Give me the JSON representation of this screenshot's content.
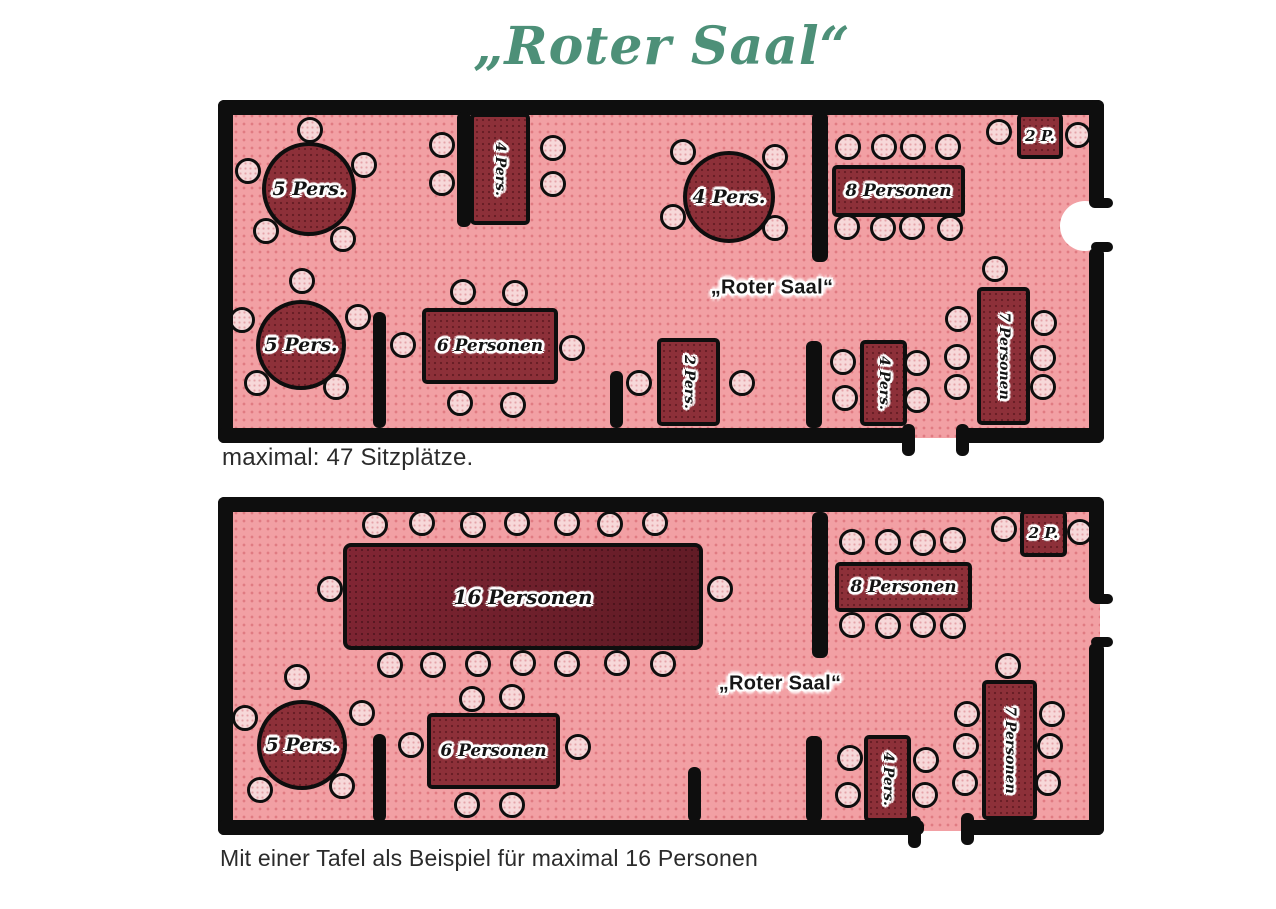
{
  "title": "„Roter Saal“",
  "colors": {
    "title": "#4d9078",
    "caption": "#2b2b2b",
    "wall": "#0e0e0e",
    "room": "#f2a0a4",
    "table": "#8d3039",
    "bigtable": "#5d1a24",
    "chair": "#f7d8d9"
  },
  "plans": [
    {
      "name": "roter-saal-standard",
      "caption": "maximal: 47 Sitzplätze.",
      "room_label": "„Roter Saal“",
      "room_label_pos": [
        772,
        288
      ],
      "room_rects": [
        [
          224,
          104,
          876,
          334
        ]
      ],
      "door_arcs": [
        [
          1060,
          201,
          50,
          50
        ]
      ],
      "walls": [
        [
          218,
          100,
          886,
          15
        ],
        [
          218,
          100,
          15,
          343
        ],
        [
          218,
          428,
          696,
          15
        ],
        [
          960,
          428,
          144,
          15
        ],
        [
          1089,
          100,
          15,
          108
        ],
        [
          1089,
          248,
          15,
          195
        ],
        [
          1091,
          198,
          22,
          10
        ],
        [
          1091,
          242,
          22,
          10
        ],
        [
          902,
          424,
          13,
          32
        ],
        [
          956,
          424,
          13,
          32
        ],
        [
          457,
          112,
          14,
          115
        ],
        [
          373,
          312,
          13,
          116
        ],
        [
          610,
          371,
          13,
          57
        ],
        [
          812,
          112,
          16,
          150
        ],
        [
          806,
          341,
          16,
          87
        ]
      ],
      "tables": [
        {
          "label": "5 Pers.",
          "shape": "round",
          "cx": 309,
          "cy": 189,
          "r": 47,
          "fs": 19,
          "chairs": [
            [
              310,
              130
            ],
            [
              248,
              171
            ],
            [
              364,
              165
            ],
            [
              266,
              231
            ],
            [
              343,
              239
            ]
          ]
        },
        {
          "label": "5 Pers.",
          "shape": "round",
          "cx": 301,
          "cy": 345,
          "r": 45,
          "fs": 19,
          "chairs": [
            [
              302,
              281
            ],
            [
              242,
              320
            ],
            [
              358,
              317
            ],
            [
              257,
              383
            ],
            [
              336,
              387
            ]
          ]
        },
        {
          "label": "4 Pers.",
          "shape": "rect",
          "rect": [
            470,
            113,
            60,
            112
          ],
          "vertical": true,
          "fs": 14,
          "chairs": [
            [
              442,
              145
            ],
            [
              442,
              183
            ],
            [
              553,
              148
            ],
            [
              553,
              184
            ]
          ]
        },
        {
          "label": "4 Pers.",
          "shape": "round",
          "cx": 729,
          "cy": 197,
          "r": 46,
          "fs": 19,
          "chairs": [
            [
              683,
              152
            ],
            [
              775,
              157
            ],
            [
              673,
              217
            ],
            [
              775,
              228
            ]
          ]
        },
        {
          "label": "8 Personen",
          "shape": "rect",
          "rect": [
            832,
            165,
            133,
            52
          ],
          "fs": 17,
          "chairs": [
            [
              848,
              147
            ],
            [
              884,
              147
            ],
            [
              913,
              147
            ],
            [
              948,
              147
            ],
            [
              847,
              227
            ],
            [
              883,
              228
            ],
            [
              912,
              227
            ],
            [
              950,
              228
            ]
          ]
        },
        {
          "label": "2 P.",
          "shape": "rect",
          "rect": [
            1017,
            113,
            46,
            46
          ],
          "fs": 15,
          "chairs": [
            [
              999,
              132
            ],
            [
              1078,
              135
            ]
          ]
        },
        {
          "label": "6 Personen",
          "shape": "rect",
          "rect": [
            422,
            308,
            136,
            76
          ],
          "fs": 17,
          "chairs": [
            [
              463,
              292
            ],
            [
              515,
              293
            ],
            [
              403,
              345
            ],
            [
              572,
              348
            ],
            [
              460,
              403
            ],
            [
              513,
              405
            ]
          ]
        },
        {
          "label": "2 Pers.",
          "shape": "rect",
          "rect": [
            657,
            338,
            63,
            88
          ],
          "vertical": true,
          "fs": 14,
          "chairs": [
            [
              639,
              383
            ],
            [
              742,
              383
            ]
          ]
        },
        {
          "label": "4 Pers.",
          "shape": "rect",
          "rect": [
            860,
            340,
            47,
            86
          ],
          "vertical": true,
          "fs": 14,
          "chairs": [
            [
              843,
              362
            ],
            [
              845,
              398
            ],
            [
              917,
              363
            ],
            [
              917,
              400
            ]
          ]
        },
        {
          "label": "7 Personen",
          "shape": "rect",
          "rect": [
            977,
            287,
            53,
            138
          ],
          "vertical": true,
          "fs": 14,
          "chairs": [
            [
              995,
              269
            ],
            [
              958,
              319
            ],
            [
              957,
              357
            ],
            [
              957,
              387
            ],
            [
              1044,
              323
            ],
            [
              1043,
              358
            ],
            [
              1043,
              387
            ]
          ]
        }
      ]
    },
    {
      "name": "roter-saal-tafel-beispiel",
      "caption": "Mit einer Tafel als Beispiel für maximal 16 Personen",
      "room_label": "„Roter Saal“",
      "room_label_pos": [
        780,
        684
      ],
      "room_rects": [
        [
          224,
          501,
          876,
          330
        ]
      ],
      "door_arcs": [],
      "walls": [
        [
          218,
          497,
          886,
          15
        ],
        [
          218,
          497,
          15,
          338
        ],
        [
          218,
          820,
          706,
          15
        ],
        [
          963,
          820,
          141,
          15
        ],
        [
          1089,
          497,
          15,
          106
        ],
        [
          1089,
          643,
          15,
          192
        ],
        [
          1091,
          594,
          22,
          10
        ],
        [
          1091,
          637,
          22,
          10
        ],
        [
          908,
          816,
          13,
          32
        ],
        [
          961,
          813,
          13,
          32
        ],
        [
          373,
          734,
          13,
          88
        ],
        [
          688,
          767,
          13,
          55
        ],
        [
          812,
          512,
          16,
          146
        ],
        [
          806,
          736,
          16,
          86
        ]
      ],
      "tables": [
        {
          "label": "16 Personen",
          "shape": "rect",
          "big": true,
          "rect": [
            343,
            543,
            360,
            107
          ],
          "fs": 20,
          "chairs": [
            [
              375,
              525
            ],
            [
              422,
              523
            ],
            [
              473,
              525
            ],
            [
              517,
              523
            ],
            [
              567,
              523
            ],
            [
              610,
              524
            ],
            [
              655,
              523
            ],
            [
              390,
              665
            ],
            [
              433,
              665
            ],
            [
              478,
              664
            ],
            [
              523,
              663
            ],
            [
              567,
              664
            ],
            [
              617,
              663
            ],
            [
              663,
              664
            ],
            [
              330,
              589
            ],
            [
              720,
              589
            ]
          ]
        },
        {
          "label": "5 Pers.",
          "shape": "round",
          "cx": 302,
          "cy": 745,
          "r": 45,
          "fs": 19,
          "chairs": [
            [
              297,
              677
            ],
            [
              245,
              718
            ],
            [
              362,
              713
            ],
            [
              260,
              790
            ],
            [
              342,
              786
            ]
          ]
        },
        {
          "label": "6 Personen",
          "shape": "rect",
          "rect": [
            427,
            713,
            133,
            76
          ],
          "fs": 17,
          "chairs": [
            [
              472,
              699
            ],
            [
              512,
              697
            ],
            [
              411,
              745
            ],
            [
              578,
              747
            ],
            [
              467,
              805
            ],
            [
              512,
              805
            ]
          ]
        },
        {
          "label": "8 Personen",
          "shape": "rect",
          "rect": [
            835,
            562,
            137,
            50
          ],
          "fs": 17,
          "chairs": [
            [
              852,
              542
            ],
            [
              888,
              542
            ],
            [
              923,
              543
            ],
            [
              953,
              540
            ],
            [
              852,
              625
            ],
            [
              888,
              626
            ],
            [
              923,
              625
            ],
            [
              953,
              626
            ]
          ]
        },
        {
          "label": "2 P.",
          "shape": "rect",
          "rect": [
            1020,
            510,
            47,
            47
          ],
          "fs": 15,
          "chairs": [
            [
              1004,
              529
            ],
            [
              1080,
              532
            ]
          ]
        },
        {
          "label": "4 Pers.",
          "shape": "rect",
          "rect": [
            864,
            735,
            47,
            87
          ],
          "vertical": true,
          "fs": 14,
          "chairs": [
            [
              850,
              758
            ],
            [
              848,
              795
            ],
            [
              926,
              760
            ],
            [
              925,
              795
            ]
          ]
        },
        {
          "label": "7 Personen",
          "shape": "rect",
          "rect": [
            982,
            680,
            55,
            140
          ],
          "vertical": true,
          "fs": 14,
          "chairs": [
            [
              1008,
              666
            ],
            [
              967,
              714
            ],
            [
              966,
              746
            ],
            [
              965,
              783
            ],
            [
              1052,
              714
            ],
            [
              1050,
              746
            ],
            [
              1048,
              783
            ]
          ]
        }
      ]
    }
  ]
}
